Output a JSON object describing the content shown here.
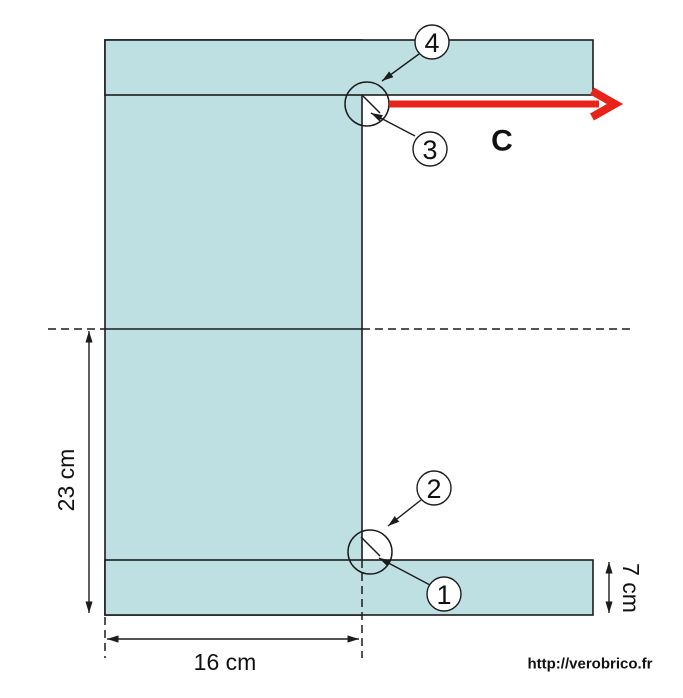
{
  "figure": {
    "colors": {
      "background": "#ffffff",
      "shape_fill": "#bee0e2",
      "outline": "#1c1c1c",
      "force_arrow": "#e8231a",
      "force_label": "#c0302c",
      "watermark": "#8a8a8a"
    },
    "dimensions": {
      "height_label": "23 cm",
      "width_label": "16 cm",
      "flange_label": "7 cm"
    },
    "force_label": "C",
    "callouts": [
      {
        "number": "1"
      },
      {
        "number": "2"
      },
      {
        "number": "3"
      },
      {
        "number": "4"
      }
    ],
    "watermark": "http://verobrico.fr"
  }
}
